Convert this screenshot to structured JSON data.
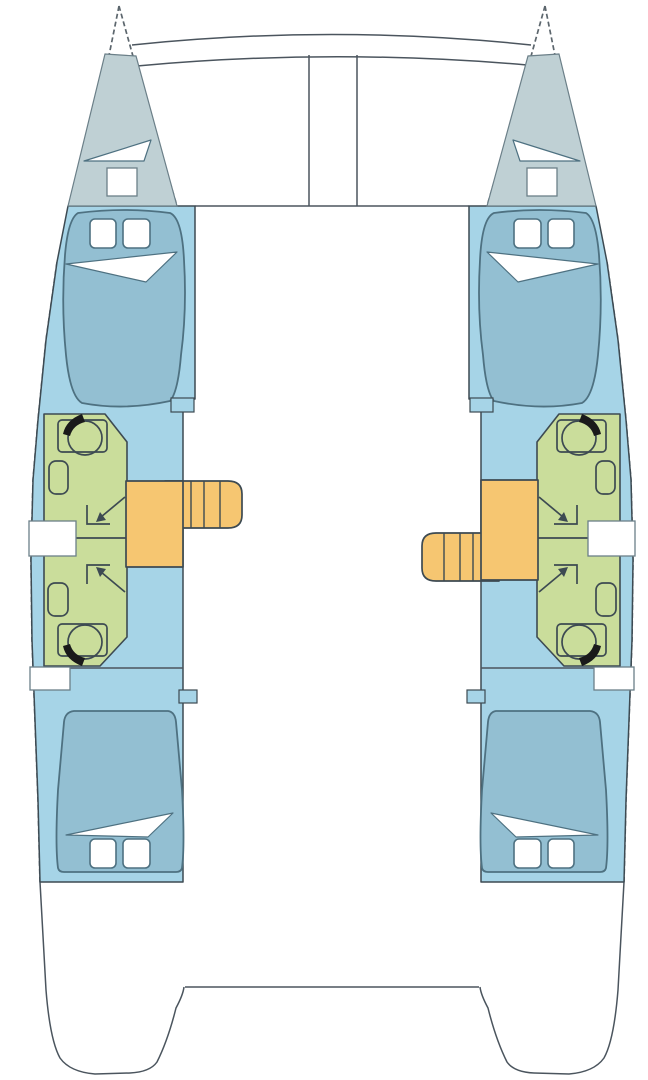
{
  "diagram": {
    "type": "boat-deck-plan",
    "vessel": "catamaran-4-cabin-layout",
    "deck": {
      "features": [
        "forward-crossbeam",
        "trampoline",
        "saloon-front-bulkhead",
        "aft-platform",
        "stern-transoms"
      ]
    },
    "hulls": [
      {
        "side": "port",
        "rooms": [
          {
            "name": "forepeak",
            "fixtures": [
              "hatch-triangle",
              "hatch-square"
            ]
          },
          {
            "name": "forward-cabin",
            "furniture": [
              "double-bed",
              "pillow",
              "pillow",
              "folded-sheet"
            ]
          },
          {
            "name": "forward-bathroom",
            "fixtures": [
              "toilet",
              "sink",
              "shower-access-arrow"
            ]
          },
          {
            "name": "aft-bathroom",
            "fixtures": [
              "toilet",
              "sink",
              "shower-access-arrow"
            ]
          },
          {
            "name": "companionway-stairs",
            "treads": 4,
            "position": "forward-of-landing"
          },
          {
            "name": "aft-cabin",
            "furniture": [
              "double-bed",
              "pillow",
              "pillow",
              "folded-sheet"
            ]
          }
        ],
        "windows": 2
      },
      {
        "side": "starboard",
        "rooms": [
          {
            "name": "forepeak",
            "fixtures": [
              "hatch-triangle",
              "hatch-square"
            ]
          },
          {
            "name": "forward-cabin",
            "furniture": [
              "double-bed",
              "pillow",
              "pillow",
              "folded-sheet"
            ]
          },
          {
            "name": "forward-bathroom",
            "fixtures": [
              "toilet",
              "sink",
              "shower-access-arrow"
            ]
          },
          {
            "name": "aft-bathroom",
            "fixtures": [
              "toilet",
              "sink",
              "shower-access-arrow"
            ]
          },
          {
            "name": "companionway-stairs",
            "treads": 4,
            "position": "aft-of-landing"
          },
          {
            "name": "aft-cabin",
            "furniture": [
              "double-bed",
              "pillow",
              "pillow",
              "folded-sheet"
            ]
          }
        ],
        "windows": 2
      }
    ]
  },
  "colors": {
    "background": "#ffffff",
    "hull_interior": "#a6d4e7",
    "forepeak": "#bfd0d4",
    "bed": "#93bfd2",
    "bathroom": "#cadd9b",
    "stairs": "#f6c671",
    "outline_dark": "#3d4a52",
    "outline_soft": "#6b7f88",
    "hull_dash": "#5c666d",
    "bed_line": "#4e7181",
    "deck_line": "#4b555e",
    "toilet_mark": "#1a1a1a"
  }
}
